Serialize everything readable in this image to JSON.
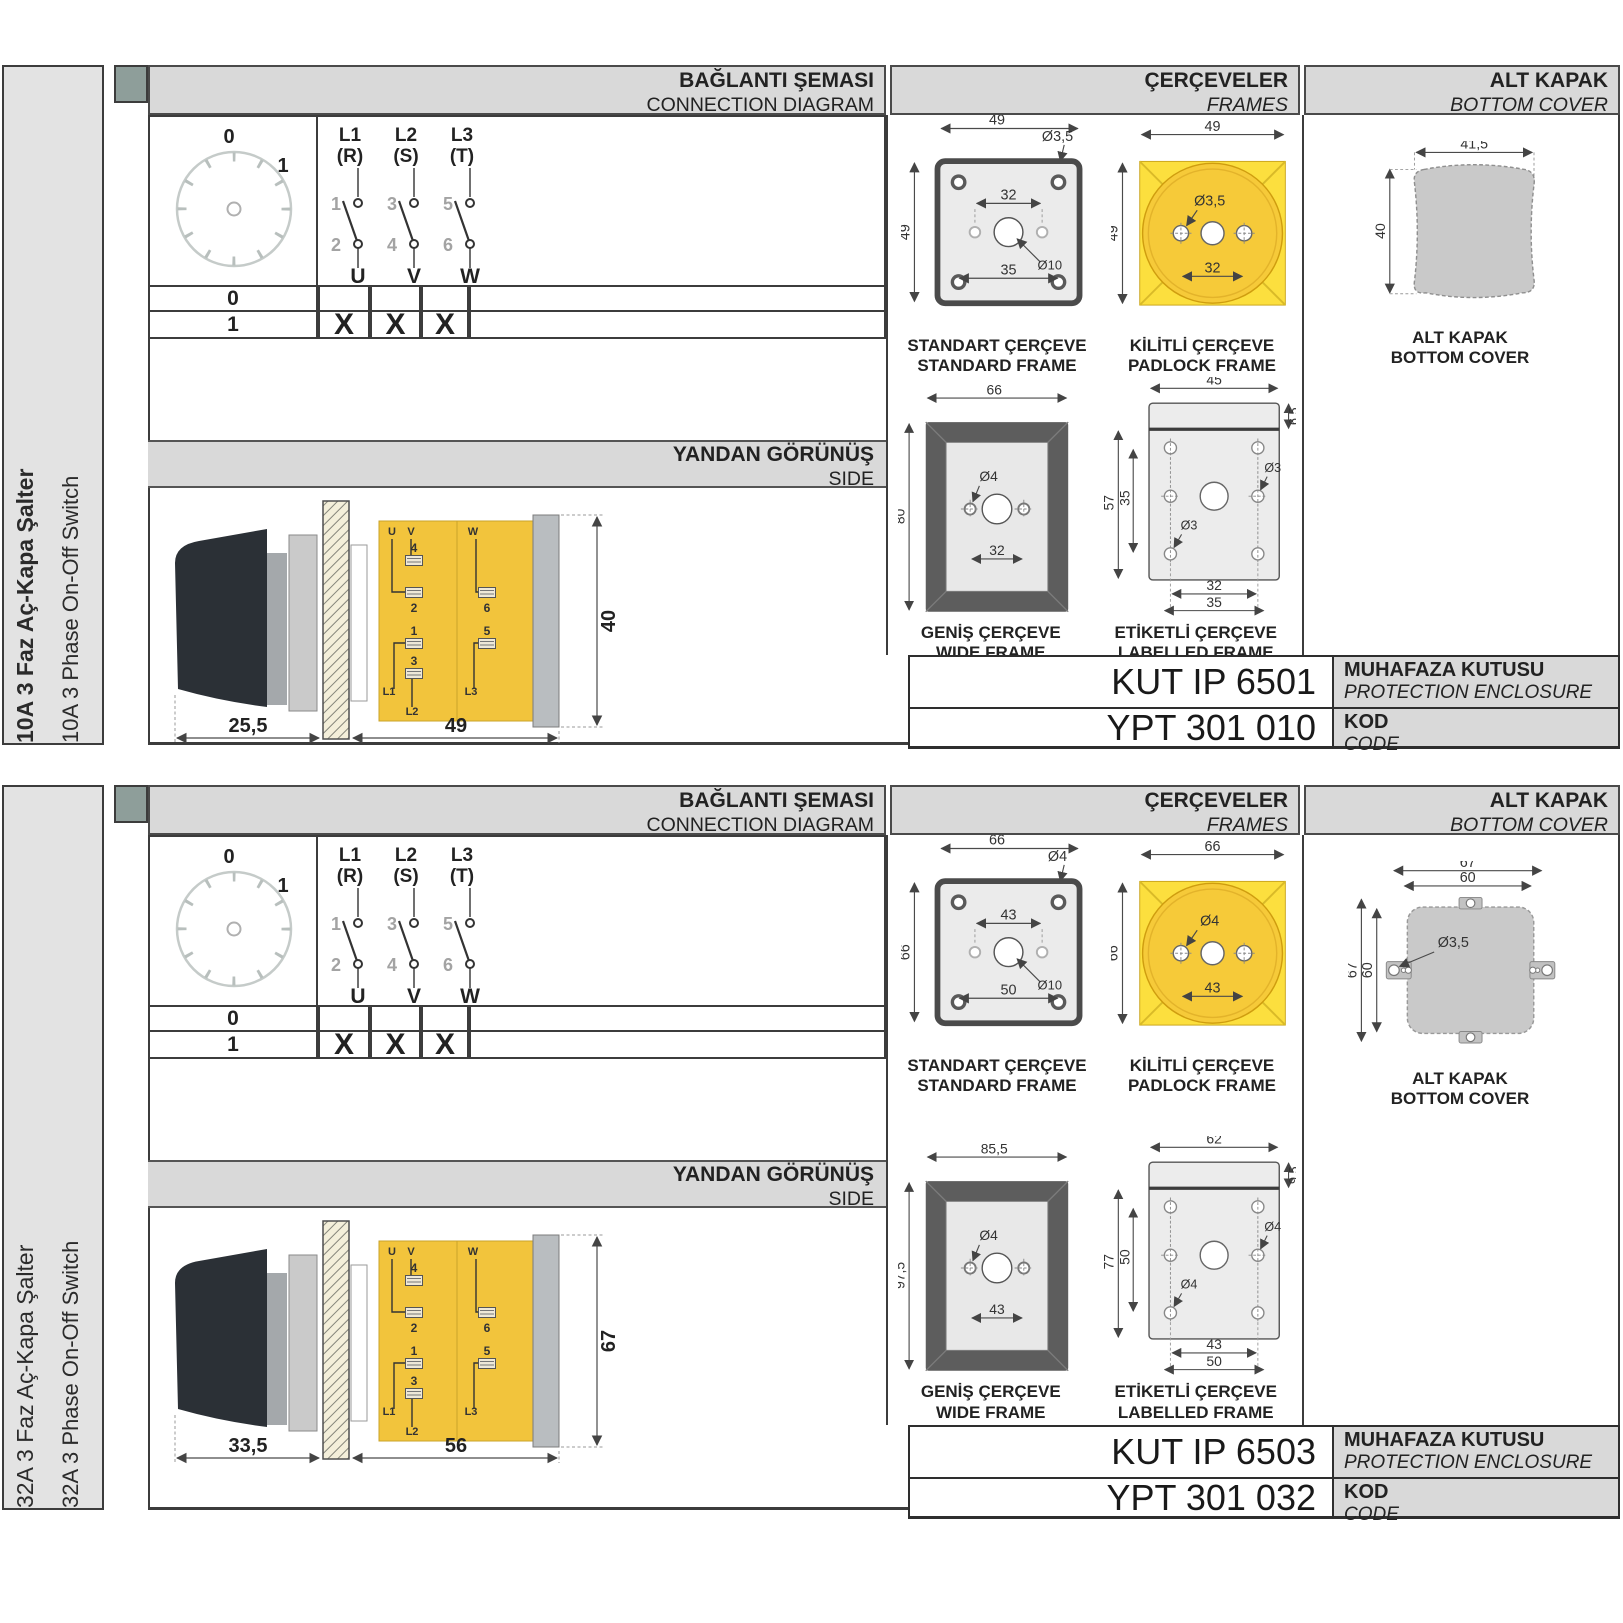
{
  "s0": {
    "sidebar": {
      "tr": "10A 3 Faz Aç-Kapa Şalter",
      "en": "10A 3 Phase On-Off Switch"
    },
    "hdr": {
      "conn_tr": "BAĞLANTI ŞEMASI",
      "conn_en": "CONNECTION DIAGRAM",
      "frames_tr": "ÇERÇEVELER",
      "frames_en": "FRAMES",
      "cover_tr": "ALT KAPAK",
      "cover_en": "BOTTOM COVER",
      "side_tr": "YANDAN GÖRÜNÜŞ",
      "side_en": "SIDE"
    },
    "dial": {
      "p0": "0",
      "p1": "1"
    },
    "con": {
      "c1t": "L1",
      "c1s": "(R)",
      "c2t": "L2",
      "c2s": "(S)",
      "c3t": "L3",
      "c3s": "(T)",
      "n1": "1",
      "n2": "2",
      "n3": "3",
      "n4": "4",
      "n5": "5",
      "n6": "6",
      "o1": "U",
      "o2": "V",
      "o3": "W"
    },
    "tbl": {
      "r0": "0",
      "r1": "1",
      "x1": "X",
      "x2": "X",
      "x3": "X"
    },
    "side": {
      "dd": "25,5",
      "dw": "49",
      "dh": "40",
      "u": "U",
      "v": "V",
      "w": "W",
      "t1": "1",
      "t2": "2",
      "t3": "3",
      "t4": "4",
      "t5": "5",
      "t6": "6",
      "l1": "L1",
      "l2": "L2",
      "l3": "L3"
    },
    "figs": {
      "std": {
        "tr": "STANDART ÇERÇEVE",
        "en": "STANDARD FRAME",
        "w": "49",
        "h": "49",
        "hole": "Ø3,5",
        "span": "32",
        "center": "Ø10",
        "span2": "35"
      },
      "pad": {
        "tr": "KİLİTLİ ÇERÇEVE",
        "en": "PADLOCK FRAME",
        "w": "49",
        "h": "49",
        "hole": "Ø3,5",
        "span": "32"
      },
      "wide": {
        "tr": "GENİŞ ÇERÇEVE",
        "en": "WIDE FRAME",
        "w": "66",
        "h": "80",
        "hole": "Ø4",
        "span": "32"
      },
      "lab": {
        "tr": "ETİKETLİ ÇERÇEVE",
        "en": "LABELLED FRAME",
        "w": "45",
        "strip": "6,5",
        "h": "57",
        "h2": "35",
        "hole_a": "Ø3",
        "hole_b": "Ø3",
        "span": "32",
        "span2": "35"
      }
    },
    "cover": {
      "tr": "ALT KAPAK",
      "en": "BOTTOM COVER",
      "w": "41,5",
      "h": "40"
    },
    "codes": {
      "enc": "KUT IP 6501",
      "enc_tr": "MUHAFAZA KUTUSU",
      "enc_en": "PROTECTION ENCLOSURE",
      "code": "YPT 301 010",
      "code_tr": "KOD",
      "code_en": "CODE"
    }
  },
  "s1": {
    "sidebar": {
      "tr": "32A 3 Faz Aç-Kapa Şalter",
      "en": "32A 3 Phase On-Off Switch"
    },
    "hdr": {
      "conn_tr": "BAĞLANTI ŞEMASI",
      "conn_en": "CONNECTION DIAGRAM",
      "frames_tr": "ÇERÇEVELER",
      "frames_en": "FRAMES",
      "cover_tr": "ALT KAPAK",
      "cover_en": "BOTTOM COVER",
      "side_tr": "YANDAN GÖRÜNÜŞ",
      "side_en": "SIDE"
    },
    "dial": {
      "p0": "0",
      "p1": "1"
    },
    "con": {
      "c1t": "L1",
      "c1s": "(R)",
      "c2t": "L2",
      "c2s": "(S)",
      "c3t": "L3",
      "c3s": "(T)",
      "n1": "1",
      "n2": "2",
      "n3": "3",
      "n4": "4",
      "n5": "5",
      "n6": "6",
      "o1": "U",
      "o2": "V",
      "o3": "W"
    },
    "tbl": {
      "r0": "0",
      "r1": "1",
      "x1": "X",
      "x2": "X",
      "x3": "X"
    },
    "side": {
      "dd": "33,5",
      "dw": "56",
      "dh": "67",
      "u": "U",
      "v": "V",
      "w": "W",
      "t1": "1",
      "t2": "2",
      "t3": "3",
      "t4": "4",
      "t5": "5",
      "t6": "6",
      "l1": "L1",
      "l2": "L2",
      "l3": "L3"
    },
    "figs": {
      "std": {
        "tr": "STANDART ÇERÇEVE",
        "en": "STANDARD FRAME",
        "w": "66",
        "h": "66",
        "hole": "Ø4",
        "span": "43",
        "center": "Ø10",
        "span2": "50"
      },
      "pad": {
        "tr": "KİLİTLİ ÇERÇEVE",
        "en": "PADLOCK FRAME",
        "w": "66",
        "h": "66",
        "hole": "Ø4",
        "span": "43"
      },
      "wide": {
        "tr": "GENİŞ ÇERÇEVE",
        "en": "WIDE FRAME",
        "w": "85,5",
        "h": "97,5",
        "hole": "Ø4",
        "span": "43"
      },
      "lab": {
        "tr": "ETİKETLİ ÇERÇEVE",
        "en": "LABELLED FRAME",
        "w": "62",
        "strip": "9,5",
        "h": "77",
        "h2": "50",
        "hole_a": "Ø4",
        "hole_b": "Ø4",
        "span": "43",
        "span2": "50"
      }
    },
    "cover": {
      "tr": "ALT KAPAK",
      "en": "BOTTOM COVER",
      "w": "67",
      "w2": "60",
      "h": "67",
      "h2": "60",
      "hole": "Ø3,5"
    },
    "codes": {
      "enc": "KUT IP 6503",
      "enc_tr": "MUHAFAZA KUTUSU",
      "enc_en": "PROTECTION ENCLOSURE",
      "code": "YPT 301 032",
      "code_tr": "KOD",
      "code_en": "CODE"
    }
  }
}
